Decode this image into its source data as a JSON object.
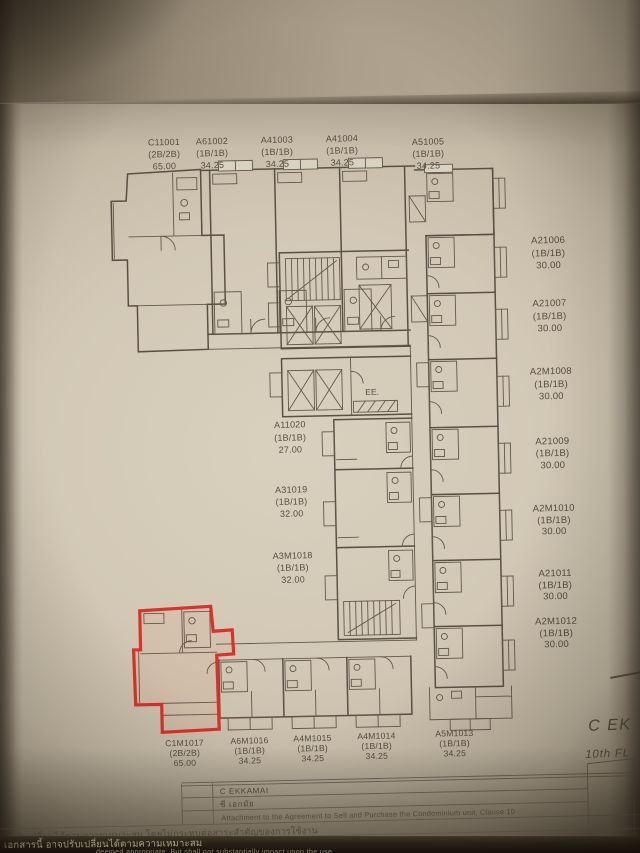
{
  "document": {
    "corner": {
      "project_name": "C EK",
      "floor_label": "10th FL"
    },
    "footer": {
      "project_en": "C EKKAMAI",
      "project_th": "ซี เอกมัย",
      "attachment_clause": "Attachment to the Agreement to Sell and Purchase the Condominium unit, Clause 10",
      "note_th": "ปรับเปลี่ยนได้ตามความเหมาะสม โดยไม่กระทบต่อสาระสำคัญของการใช้งาน",
      "doc_note_th": "เอกสารนี้ อาจปรับเปลี่ยนได้ตามความเหมาะสม",
      "doc_note_en": "deemed appropriate, But shall not substantially impact upon the use"
    }
  },
  "floor_plan": {
    "highlighted_unit": "C1M1017",
    "highlight_color": "#e8211a",
    "core": {
      "elevator_room_label": "EE."
    },
    "units": {
      "top": [
        {
          "id": "C11001",
          "type": "(2B/2B)",
          "area": "65.00"
        },
        {
          "id": "A61002",
          "type": "(1B/1B)",
          "area": "34.25"
        },
        {
          "id": "A41003",
          "type": "(1B/1B)",
          "area": "34.25"
        },
        {
          "id": "A41004",
          "type": "(1B/1B)",
          "area": "34.25"
        },
        {
          "id": "A51005",
          "type": "(1B/1B)",
          "area": "34.25"
        }
      ],
      "right": [
        {
          "id": "A21006",
          "type": "(1B/1B)",
          "area": "30.00"
        },
        {
          "id": "A21007",
          "type": "(1B/1B)",
          "area": "30.00"
        },
        {
          "id": "A2M1008",
          "type": "(1B/1B)",
          "area": "30.00"
        },
        {
          "id": "A21009",
          "type": "(1B/1B)",
          "area": "30.00"
        },
        {
          "id": "A2M1010",
          "type": "(1B/1B)",
          "area": "30.00"
        },
        {
          "id": "A21011",
          "type": "(1B/1B)",
          "area": "30.00"
        },
        {
          "id": "A2M1012",
          "type": "(1B/1B)",
          "area": "30.00"
        }
      ],
      "middle": [
        {
          "id": "A11020",
          "type": "(1B/1B)",
          "area": "27.00"
        },
        {
          "id": "A31019",
          "type": "(1B/1B)",
          "area": "32.00"
        },
        {
          "id": "A3M1018",
          "type": "(1B/1B)",
          "area": "32.00"
        }
      ],
      "bottom": [
        {
          "id": "C1M1017",
          "type": "(2B/2B)",
          "area": "65.00"
        },
        {
          "id": "A6M1016",
          "type": "(1B/1B)",
          "area": "34.25"
        },
        {
          "id": "A4M1015",
          "type": "(1B/1B)",
          "area": "34.25"
        },
        {
          "id": "A4M1014",
          "type": "(1B/1B)",
          "area": "34.25"
        },
        {
          "id": "A5M1013",
          "type": "(1B/1B)",
          "area": "34.25"
        }
      ]
    }
  }
}
